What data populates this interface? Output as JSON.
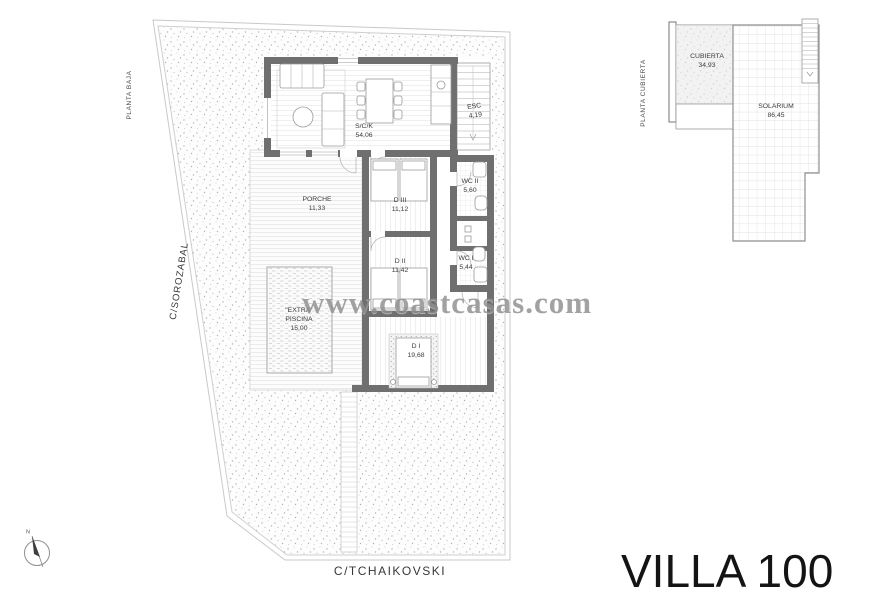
{
  "page": {
    "title": "VILLA 100"
  },
  "watermark": {
    "text": "www.coastcasas.com"
  },
  "streets": {
    "left": "C/SOROZABAL",
    "bottom": "C/TCHAIKOVSKI"
  },
  "ground_floor": {
    "label": "PLANTA BAJA",
    "rooms": {
      "sck": {
        "name": "S/C/K",
        "area": "54,06"
      },
      "esc": {
        "name": "ESC",
        "area": "4,19"
      },
      "porche": {
        "name": "PORCHE",
        "area": "11,33"
      },
      "d3": {
        "name": "D III",
        "area": "11,12"
      },
      "d2": {
        "name": "D II",
        "area": "11,42"
      },
      "d1": {
        "name": "D I",
        "area": "19,68"
      },
      "wc2": {
        "name": "WC II",
        "area": "5,60"
      },
      "wc1": {
        "name": "WC I",
        "area": "5,44"
      },
      "piscina": {
        "name": "\"EXTRA\"",
        "name2": "PISCINA",
        "area": "15,00"
      }
    }
  },
  "roof": {
    "label": "PLANTA CUBIERTA",
    "rooms": {
      "cubierta": {
        "name": "CUBIERTA",
        "area": "34,93"
      },
      "solarium": {
        "name": "SOLARIUM",
        "area": "86,45"
      }
    }
  },
  "compass": {
    "north": "N"
  },
  "colors": {
    "wall": "#6f6f6f",
    "boundary": "#c9c9c9",
    "deck_line": "#e4e4e4",
    "watermark": "#8e8e8e",
    "title": "#141414"
  }
}
